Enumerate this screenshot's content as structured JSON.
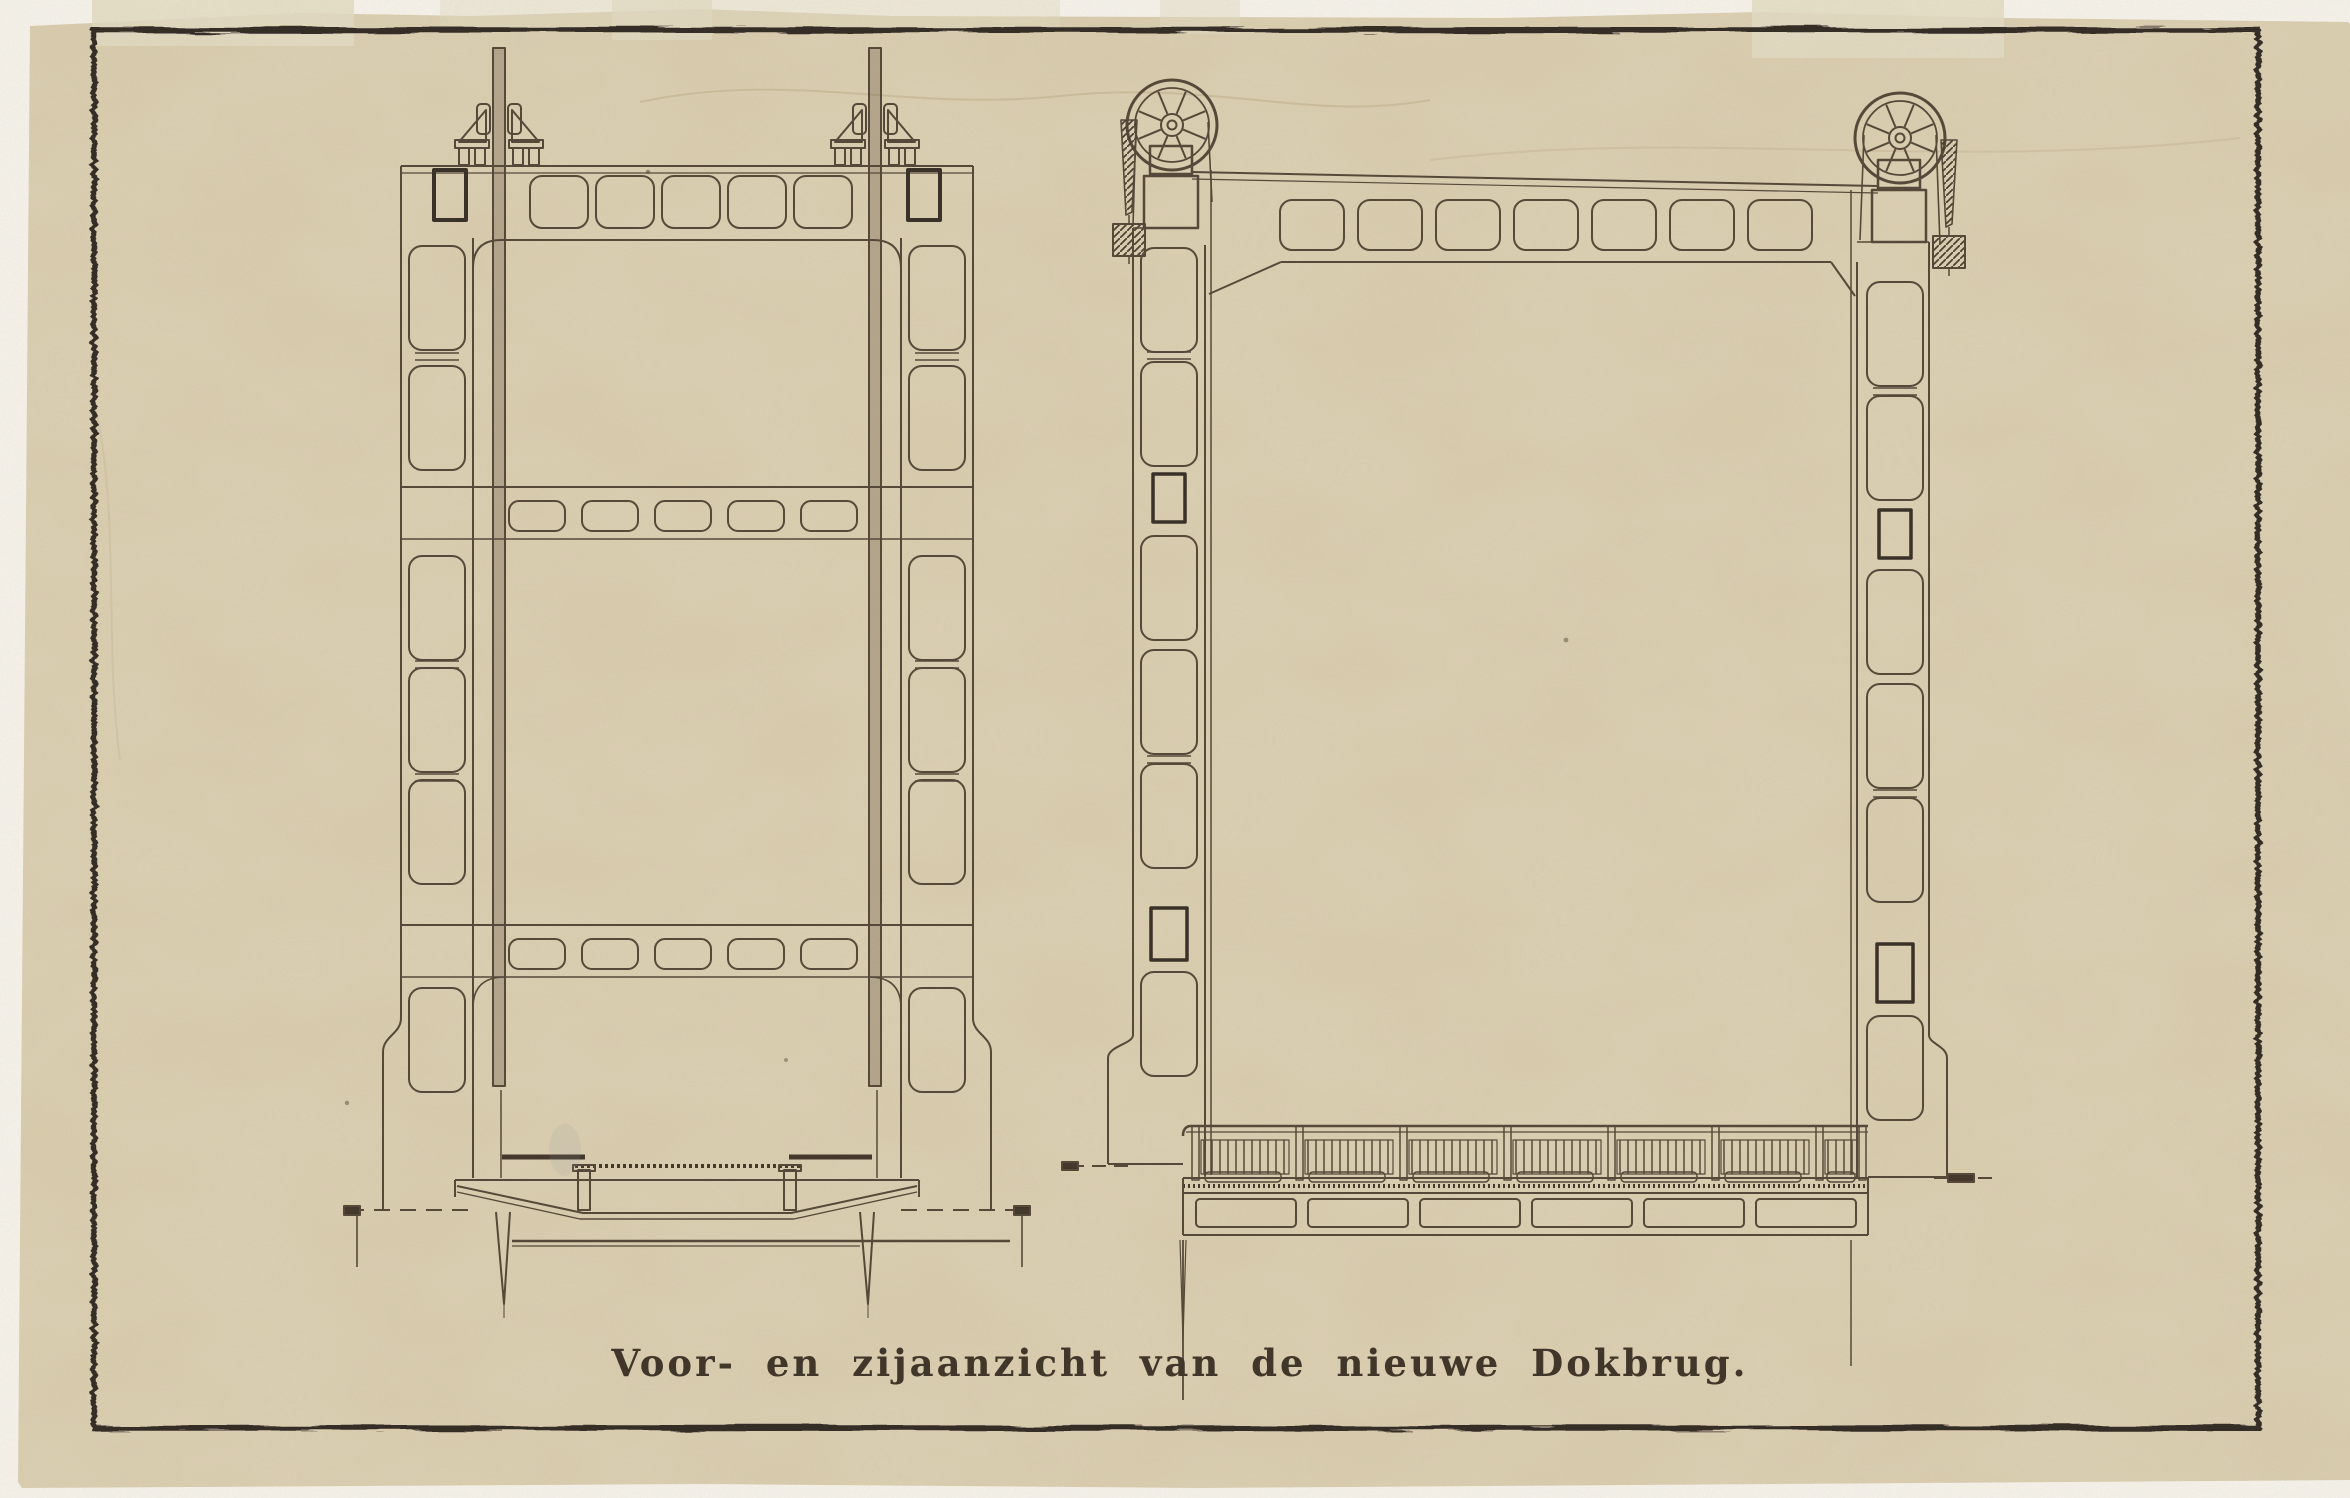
{
  "document": {
    "caption": "Voor- en zijaanzicht van de nieuwe Dokbrug."
  },
  "palette": {
    "backdrop": "#f6f3ec",
    "paper": "#d8cbac",
    "tape": "#e0d9bf",
    "ink": "#56493a",
    "ink_dark": "#3a3129",
    "border_ink": "#362f28",
    "caption_ink": "#41362a"
  }
}
